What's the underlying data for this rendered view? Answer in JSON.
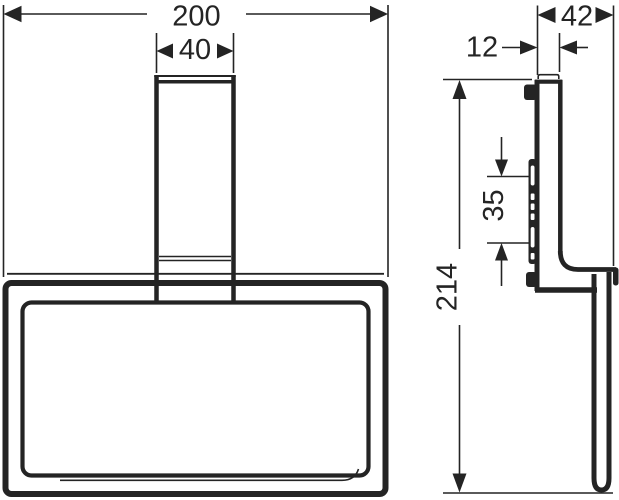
{
  "colors": {
    "line": "#242424",
    "background": "#ffffff"
  },
  "dimensions": {
    "overall_width": {
      "value": "200",
      "orientation": "horizontal",
      "view": "front"
    },
    "post_width": {
      "value": "40",
      "orientation": "horizontal",
      "view": "front"
    },
    "overall_depth": {
      "value": "42",
      "orientation": "horizontal",
      "view": "side"
    },
    "plate_depth": {
      "value": "12",
      "orientation": "horizontal",
      "view": "side"
    },
    "hole_spacing": {
      "value": "35",
      "orientation": "vertical",
      "view": "side"
    },
    "overall_height": {
      "value": "214",
      "orientation": "vertical",
      "view": "side"
    }
  }
}
